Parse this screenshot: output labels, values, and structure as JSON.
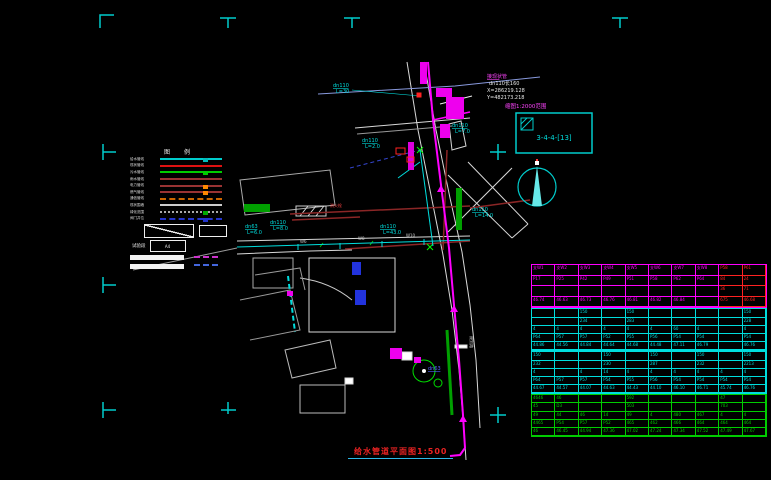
{
  "title": {
    "text": "给水管道平面图1:500"
  },
  "index_box": {
    "caption": "缩图1:2000范围",
    "label": "3-4-4-[13]"
  },
  "legend": {
    "header": "图 例",
    "rows": [
      {
        "label": "给水管线",
        "color": "#00cccc",
        "style": "solid",
        "marker": "#00bbbb"
      },
      {
        "label": "现状管线",
        "color": "#dd1111",
        "style": "solid",
        "marker": ""
      },
      {
        "label": "污水管线",
        "color": "#00cc00",
        "style": "solid",
        "marker": "#00cc00"
      },
      {
        "label": "雨水管线",
        "color": "#993333",
        "style": "solid",
        "marker": ""
      },
      {
        "label": "电力管线",
        "color": "#993333",
        "style": "solid",
        "marker": "#ff8800"
      },
      {
        "label": "燃气管线",
        "color": "#993333",
        "style": "solid",
        "marker": "#ff8800"
      },
      {
        "label": "通信管线",
        "color": "#cc6600",
        "style": "dashed",
        "marker": ""
      },
      {
        "label": "现状围墙",
        "color": "#cccccc",
        "style": "solid",
        "marker": ""
      },
      {
        "label": "绿化范围",
        "color": "#aaaaaa",
        "style": "dotted",
        "marker": "#00aa00"
      },
      {
        "label": "阀门井位",
        "color": "#2233cc",
        "style": "dashed",
        "marker": "#2233cc"
      }
    ],
    "test_section_label": "试验段",
    "test_box_label": "A4"
  },
  "map": {
    "labels": [
      {
        "x": 333,
        "y": 87,
        "text": "dn110",
        "color": "#00dddd",
        "size": 5,
        "underline": true
      },
      {
        "x": 336,
        "y": 93,
        "text": "L=30",
        "color": "#00dddd",
        "size": 5
      },
      {
        "x": 452,
        "y": 127,
        "text": "dn110",
        "color": "#00dddd",
        "size": 5,
        "underline": true
      },
      {
        "x": 455,
        "y": 133,
        "text": "L=7.0",
        "color": "#00dddd",
        "size": 5
      },
      {
        "x": 380,
        "y": 228,
        "text": "dn110",
        "color": "#00dddd",
        "size": 5,
        "underline": true
      },
      {
        "x": 383,
        "y": 234,
        "text": "L=43.0",
        "color": "#00dddd",
        "size": 5
      },
      {
        "x": 245,
        "y": 228,
        "text": "dn63",
        "color": "#00dddd",
        "size": 5,
        "underline": true
      },
      {
        "x": 247,
        "y": 234,
        "text": "L=6.0",
        "color": "#00dddd",
        "size": 5
      },
      {
        "x": 270,
        "y": 224,
        "text": "dn110",
        "color": "#00dddd",
        "size": 5,
        "underline": true
      },
      {
        "x": 273,
        "y": 230,
        "text": "L=8.0",
        "color": "#00dddd",
        "size": 5
      },
      {
        "x": 472,
        "y": 211,
        "text": "dn110",
        "color": "#00dddd",
        "size": 5,
        "underline": true
      },
      {
        "x": 475,
        "y": 217,
        "text": "L=14.0",
        "color": "#00dddd",
        "size": 5
      },
      {
        "x": 362,
        "y": 142,
        "text": "dn110",
        "color": "#00dddd",
        "size": 5,
        "underline": true
      },
      {
        "x": 365,
        "y": 148,
        "text": "L=2.0",
        "color": "#00dddd",
        "size": 5
      },
      {
        "x": 487,
        "y": 78,
        "text": "接现状管",
        "color": "#ff44ff",
        "size": 5,
        "underline": true
      },
      {
        "x": 489,
        "y": 85,
        "text": "dn110长160",
        "color": "#e8e8e8",
        "size": 5
      },
      {
        "x": 487,
        "y": 92,
        "text": "X=286219.128",
        "color": "#e8e8e8",
        "size": 5
      },
      {
        "x": 487,
        "y": 99,
        "text": "Y=482173.218",
        "color": "#e8e8e8",
        "size": 5
      },
      {
        "x": 300,
        "y": 243,
        "text": "W6",
        "color": "#cccccc",
        "size": 4
      },
      {
        "x": 358,
        "y": 240,
        "text": "W8",
        "color": "#cccccc",
        "size": 4
      },
      {
        "x": 406,
        "y": 237,
        "text": "W10",
        "color": "#cccccc",
        "size": 4
      },
      {
        "x": 470,
        "y": 336,
        "text": "规划路",
        "color": "#cccccc",
        "size": 4,
        "rotate": true
      },
      {
        "x": 330,
        "y": 207,
        "text": "消火栓",
        "color": "#ff4444",
        "size": 4
      },
      {
        "x": 428,
        "y": 370,
        "text": "dn63",
        "color": "#5566ff",
        "size": 5,
        "underline": true
      }
    ]
  },
  "table": {
    "red_color": "#ff2222",
    "sections": [
      {
        "color": "#ff00ff",
        "cls": "s1",
        "red_cols": [
          8,
          9
        ],
        "rows": [
          [
            "支W1",
            "支W2",
            "支W3",
            "支W4",
            "支W5",
            "支W6",
            "支W7",
            "支W8",
            "P58",
            "P61"
          ],
          [
            "P17",
            "P25",
            "P42",
            "P49",
            "P51",
            "P58",
            "P62",
            "P64",
            "84",
            "24"
          ],
          [
            "",
            "",
            "",
            "",
            "",
            "",
            "",
            "",
            "36",
            "71"
          ],
          [
            "46.74",
            "46.63",
            "46.73",
            "46.76",
            "46.81",
            "46.82",
            "46.84",
            "",
            "675",
            "46.68"
          ]
        ]
      },
      {
        "color": "#00dddd",
        "cls": "s2",
        "red_cols": [],
        "rows": [
          [
            "",
            "",
            "150",
            "",
            "150",
            "",
            "",
            "",
            "",
            "150"
          ],
          [
            "",
            "",
            "234",
            "",
            "283",
            "",
            "",
            "",
            "",
            "228"
          ],
          [
            "4",
            "4",
            "4",
            "4",
            "4",
            "4",
            "60",
            "4",
            "",
            "4"
          ],
          [
            "P64",
            "P57",
            "P57",
            "P52",
            "P55",
            "P56",
            "P54",
            "P54",
            "",
            "P54"
          ],
          [
            "44.86",
            "44.56",
            "44.84",
            "44.64",
            "44.68",
            "44.48",
            "47.11",
            "46.79",
            "",
            "46.76"
          ]
        ]
      },
      {
        "color": "#00dddd",
        "cls": "s3",
        "red_cols": [],
        "rows": [
          [
            "150",
            "",
            "",
            "150",
            "",
            "150",
            "",
            "150",
            "",
            "150"
          ],
          [
            "232",
            "",
            "",
            "230",
            "",
            "287",
            "",
            "232",
            "",
            "2213"
          ],
          [
            "4",
            "",
            "4",
            "14",
            "4",
            "4",
            "4",
            "4",
            "4",
            "4"
          ],
          [
            "P64",
            "P57",
            "P57",
            "P54",
            "P55",
            "P56",
            "P54",
            "P54",
            "P54",
            "P54"
          ],
          [
            "44.67",
            "44.57",
            "44.07",
            "44.63",
            "44.43",
            "44.10",
            "46.10",
            "46.71",
            "45.74",
            "46.76"
          ]
        ]
      },
      {
        "color": "#00cc00",
        "cls": "s4",
        "red_cols": [],
        "rows": [
          [
            "4646",
            "46",
            "",
            "",
            "592",
            "",
            "",
            "",
            "47",
            ""
          ],
          [
            "45",
            "D3",
            "",
            "",
            "503",
            "",
            "",
            "",
            "703",
            ""
          ],
          [
            "49",
            "44",
            "46",
            "14",
            "49",
            "4",
            "480",
            "467",
            "4",
            "4"
          ],
          [
            "4465",
            "P54",
            "P57",
            "P52",
            "465",
            "462",
            "466",
            "464",
            "464",
            "464"
          ],
          [
            "46",
            "46.45",
            "44.94",
            "47.36",
            "47.02",
            "47.24",
            "47.34",
            "47.52",
            "47.49",
            "47.67"
          ]
        ]
      }
    ]
  }
}
